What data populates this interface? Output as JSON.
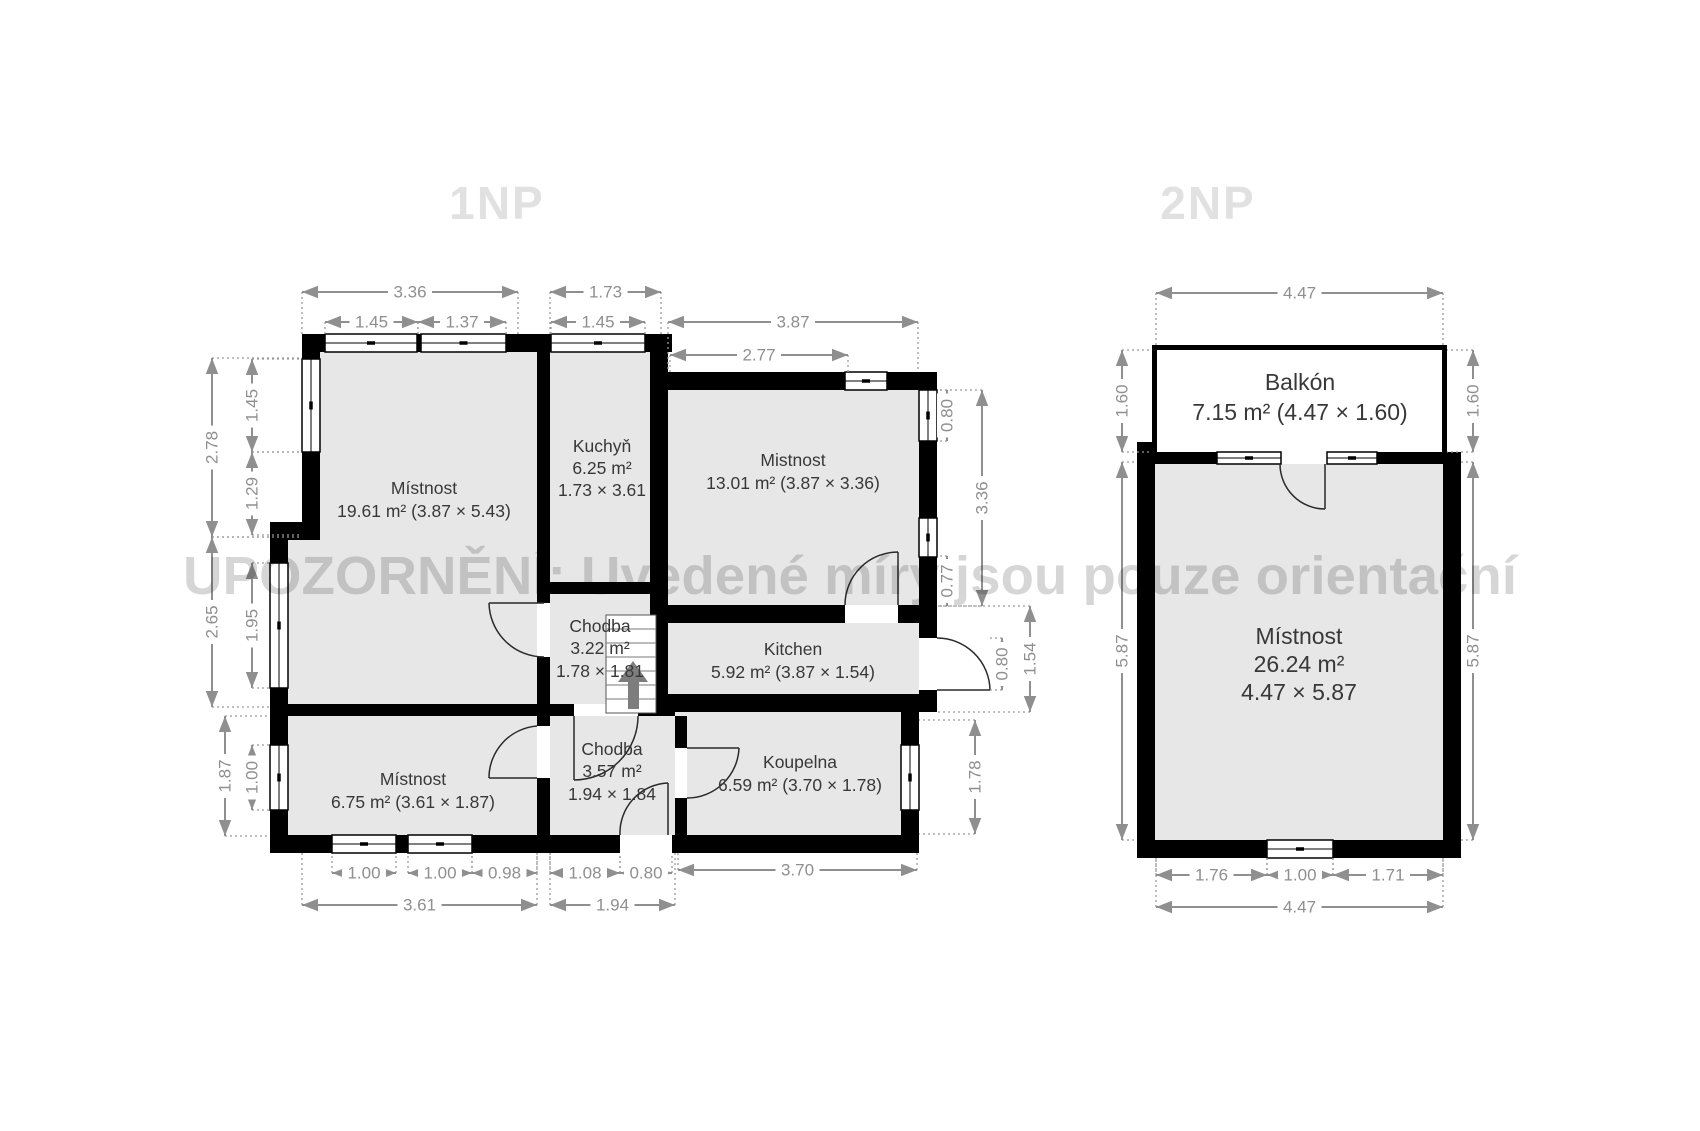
{
  "watermark": "UPOZORNĚNÍ: Uvedené míry jsou pouze orientační",
  "colors": {
    "wall": "#000000",
    "room_fill": "#e7e7e7",
    "dimension": "#8f8f8f",
    "title": "#e1e1e1",
    "label": "#383838"
  },
  "f1": {
    "title": "1NP",
    "rooms": [
      {
        "name": "Místnost",
        "area": "19.61 m² (3.87 × 5.43)"
      },
      {
        "name": "Kuchyň",
        "area": "6.25 m²",
        "dims": "1.73 × 3.61"
      },
      {
        "name": "Mistnost",
        "area": "13.01 m² (3.87 × 3.36)"
      },
      {
        "name": "Kitchen",
        "area": "5.92 m² (3.87 × 1.54)"
      },
      {
        "name": "Chodba",
        "area": "3.22 m²",
        "dims": "1.78 × 1.81"
      },
      {
        "name": "Místnost",
        "area": "6.75 m² (3.61 × 1.87)"
      },
      {
        "name": "Chodba",
        "area": "3.57 m²",
        "dims": "1.94 × 1.84"
      },
      {
        "name": "Koupelna",
        "area": "6.59 m² (3.70 × 1.78)"
      }
    ],
    "dims": {
      "top": [
        "3.36",
        "1.73",
        "1.45",
        "1.37",
        "1.45",
        "3.87",
        "2.77"
      ],
      "left": [
        "2.78",
        "1.45",
        "1.29",
        "2.65",
        "1.95",
        "1.87",
        "1.00"
      ],
      "right": [
        "0.80",
        "3.36",
        "0.77",
        "0.80",
        "1.54",
        "1.78"
      ],
      "bottom": [
        "1.00",
        "1.00",
        "0.98",
        "1.08",
        "0.80",
        "3.70",
        "3.61",
        "1.94"
      ]
    }
  },
  "f2": {
    "title": "2NP",
    "rooms": [
      {
        "name": "Balkón",
        "area": "7.15 m² (4.47 × 1.60)"
      },
      {
        "name": "Místnost",
        "area": "26.24 m²",
        "dims": "4.47 × 5.87"
      }
    ],
    "dims": {
      "top": [
        "4.47"
      ],
      "left": [
        "1.60",
        "5.87"
      ],
      "right": [
        "1.60",
        "5.87"
      ],
      "bottom": [
        "1.76",
        "1.00",
        "1.71",
        "4.47"
      ]
    }
  }
}
